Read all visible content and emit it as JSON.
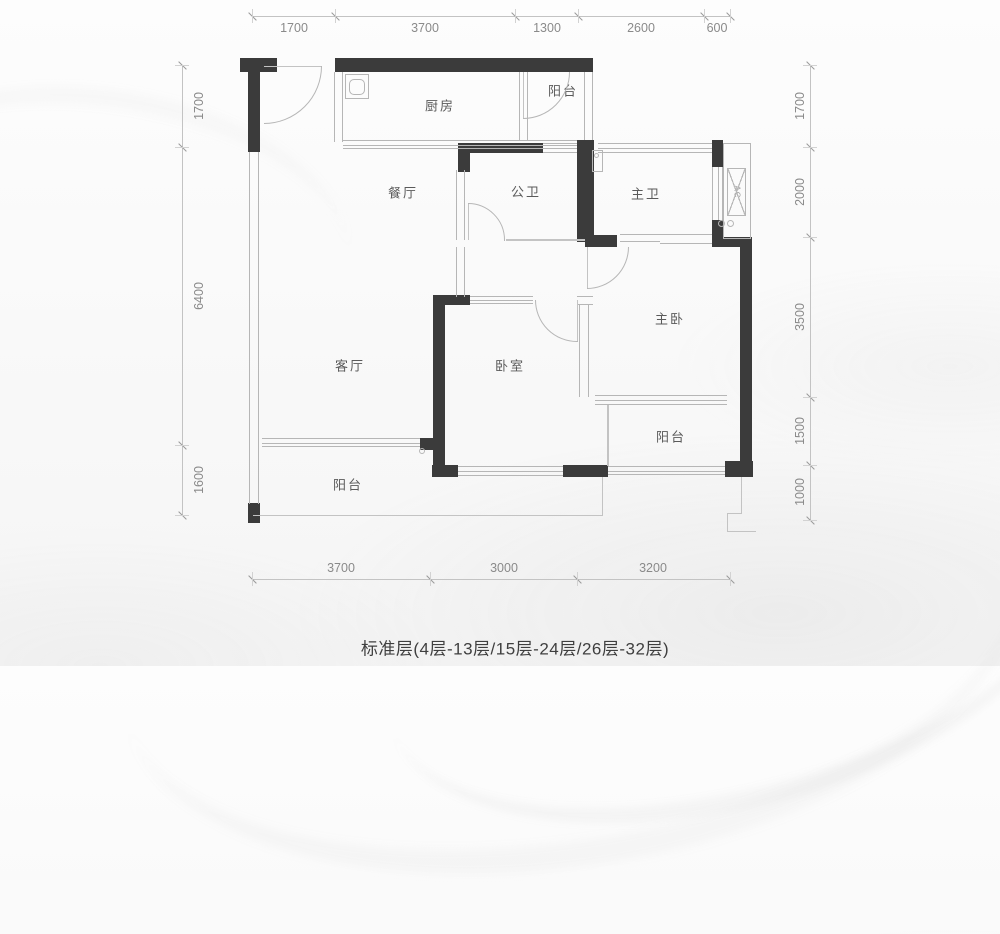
{
  "caption": "标准层(4层-13层/15层-24层/26层-32层)",
  "ac_label": "AC",
  "rooms": [
    {
      "name": "kitchen",
      "label": "厨房"
    },
    {
      "name": "balcony-top",
      "label": "阳台"
    },
    {
      "name": "dining-room",
      "label": "餐厅"
    },
    {
      "name": "public-bathroom",
      "label": "公卫"
    },
    {
      "name": "master-bathroom",
      "label": "主卫"
    },
    {
      "name": "master-bedroom",
      "label": "主卧"
    },
    {
      "name": "living-room",
      "label": "客厅"
    },
    {
      "name": "bedroom",
      "label": "卧室"
    },
    {
      "name": "balcony-right",
      "label": "阳台"
    },
    {
      "name": "balcony-left",
      "label": "阳台"
    }
  ],
  "dims": {
    "top": [
      "1700",
      "3700",
      "1300",
      "2600",
      "600"
    ],
    "left": [
      "1700",
      "6400",
      "1600"
    ],
    "right": [
      "1700",
      "2000",
      "3500",
      "1500",
      "1000"
    ],
    "bottom": [
      "3700",
      "3000",
      "3200"
    ]
  },
  "colors": {
    "wall": "#3b3b3b",
    "thin_line": "#b6b6b6",
    "dim_text": "#8a8a8a",
    "label_text": "#5a5a5a"
  }
}
